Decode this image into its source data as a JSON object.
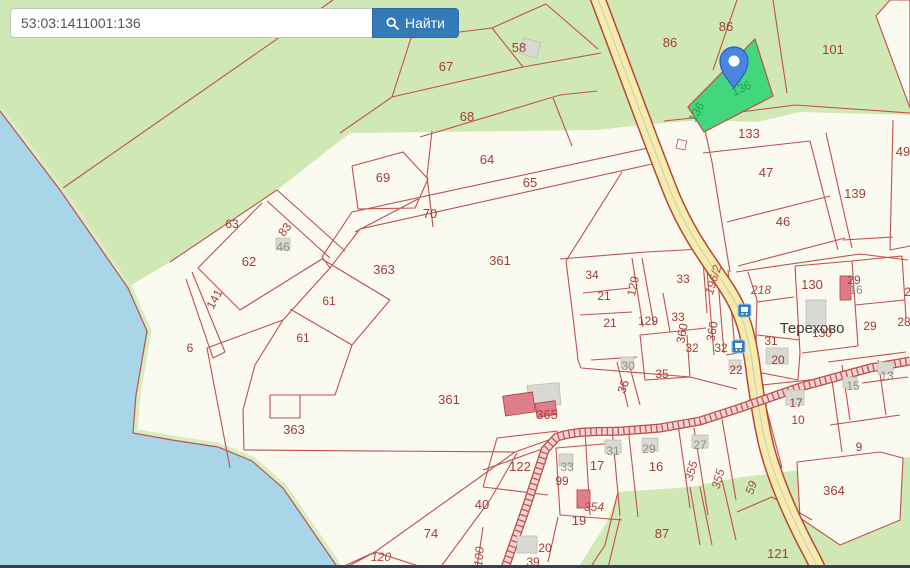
{
  "search": {
    "value": "53:03:1411001:136",
    "placeholder": "",
    "button_label": "Найти"
  },
  "map": {
    "place_label": "Терехово",
    "highlighted_parcel": "136",
    "colors": {
      "accent_button": "#337ab7",
      "parcel_line": "#c0504d",
      "highlight_parcel_fill": "#42d77d",
      "water": "#a8d5e8",
      "forest": "#cfe8b4",
      "land": "#fbfaf1",
      "road_fill": "#f6edaa",
      "building": "#d9d9d3",
      "building_red": "#e07b84"
    },
    "labels": [
      {
        "t": "58",
        "x": 519,
        "y": 52,
        "c": "r13"
      },
      {
        "t": "67",
        "x": 446,
        "y": 71,
        "c": "r13"
      },
      {
        "t": "68",
        "x": 467,
        "y": 121,
        "c": "r13"
      },
      {
        "t": "86",
        "x": 670,
        "y": 47,
        "c": "r13"
      },
      {
        "t": "86",
        "x": 726,
        "y": 31,
        "c": "r13"
      },
      {
        "t": "101",
        "x": 833,
        "y": 54,
        "c": "r13"
      },
      {
        "t": "49",
        "x": 903,
        "y": 156,
        "c": "r13"
      },
      {
        "t": "133",
        "x": 749,
        "y": 138,
        "c": "r13"
      },
      {
        "t": "47",
        "x": 766,
        "y": 177,
        "c": "r13"
      },
      {
        "t": "46",
        "x": 783,
        "y": 226,
        "c": "r13"
      },
      {
        "t": "139",
        "x": 855,
        "y": 198,
        "c": "r13"
      },
      {
        "t": "64",
        "x": 487,
        "y": 164,
        "c": "r13"
      },
      {
        "t": "65",
        "x": 530,
        "y": 187,
        "c": "r13"
      },
      {
        "t": "69",
        "x": 383,
        "y": 182,
        "c": "r13"
      },
      {
        "t": "70",
        "x": 430,
        "y": 218,
        "c": "r13"
      },
      {
        "t": "63",
        "x": 232,
        "y": 228
      },
      {
        "t": "83",
        "x": 288,
        "y": 232,
        "r": -52
      },
      {
        "t": "46",
        "x": 283,
        "y": 251,
        "c": "gray"
      },
      {
        "t": "62",
        "x": 249,
        "y": 266,
        "c": "r13"
      },
      {
        "t": "141",
        "x": 218,
        "y": 301,
        "r": -62
      },
      {
        "t": "61",
        "x": 329,
        "y": 305
      },
      {
        "t": "61",
        "x": 303,
        "y": 342
      },
      {
        "t": "6",
        "x": 190,
        "y": 352
      },
      {
        "t": "363",
        "x": 384,
        "y": 274,
        "c": "r13"
      },
      {
        "t": "361",
        "x": 500,
        "y": 265,
        "c": "r13"
      },
      {
        "t": "361",
        "x": 449,
        "y": 404,
        "c": "r13"
      },
      {
        "t": "363",
        "x": 294,
        "y": 434,
        "c": "r13"
      },
      {
        "t": "34",
        "x": 592,
        "y": 279
      },
      {
        "t": "21",
        "x": 604,
        "y": 300
      },
      {
        "t": "21",
        "x": 610,
        "y": 327
      },
      {
        "t": "129",
        "x": 637,
        "y": 287,
        "r": -78
      },
      {
        "t": "129",
        "x": 648,
        "y": 325
      },
      {
        "t": "33",
        "x": 683,
        "y": 283
      },
      {
        "t": "33",
        "x": 678,
        "y": 321
      },
      {
        "t": "360",
        "x": 686,
        "y": 334,
        "r": -80
      },
      {
        "t": "32",
        "x": 692,
        "y": 352
      },
      {
        "t": "360",
        "x": 716,
        "y": 332,
        "r": -80
      },
      {
        "t": "32",
        "x": 721,
        "y": 352
      },
      {
        "t": "35",
        "x": 662,
        "y": 378
      },
      {
        "t": "36",
        "x": 627,
        "y": 388,
        "r": -70
      },
      {
        "t": "30",
        "x": 628,
        "y": 370,
        "c": "gray"
      },
      {
        "t": "196/2",
        "x": 717,
        "y": 281,
        "r": -73,
        "c": "ri"
      },
      {
        "t": "218",
        "x": 761,
        "y": 294,
        "c": "ital"
      },
      {
        "t": "130",
        "x": 812,
        "y": 289,
        "c": "r13"
      },
      {
        "t": "29",
        "x": 854,
        "y": 284
      },
      {
        "t": "16",
        "x": 856,
        "y": 294,
        "c": "gray"
      },
      {
        "t": "29",
        "x": 870,
        "y": 330
      },
      {
        "t": "28",
        "x": 904,
        "y": 326
      },
      {
        "t": "29",
        "x": 911,
        "y": 296
      },
      {
        "t": "Терехово",
        "x": 812,
        "y": 333,
        "c": "place"
      },
      {
        "t": "130",
        "x": 822,
        "y": 337
      },
      {
        "t": "31",
        "x": 771,
        "y": 345
      },
      {
        "t": "20",
        "x": 778,
        "y": 364
      },
      {
        "t": "22",
        "x": 736,
        "y": 374
      },
      {
        "t": "13",
        "x": 887,
        "y": 380,
        "c": "gray"
      },
      {
        "t": "15",
        "x": 853,
        "y": 390,
        "c": "gray"
      },
      {
        "t": "17",
        "x": 796,
        "y": 407
      },
      {
        "t": "10",
        "x": 798,
        "y": 424
      },
      {
        "t": "9",
        "x": 859,
        "y": 451
      },
      {
        "t": "59",
        "x": 755,
        "y": 489,
        "r": -70,
        "c": "ri"
      },
      {
        "t": "364",
        "x": 834,
        "y": 495,
        "c": "r13"
      },
      {
        "t": "121",
        "x": 778,
        "y": 558,
        "c": "r13"
      },
      {
        "t": "122",
        "x": 520,
        "y": 471,
        "c": "r13"
      },
      {
        "t": "99",
        "x": 562,
        "y": 485
      },
      {
        "t": "33",
        "x": 567,
        "y": 471,
        "c": "gray"
      },
      {
        "t": "17",
        "x": 597,
        "y": 470,
        "c": "r13"
      },
      {
        "t": "31",
        "x": 613,
        "y": 455,
        "c": "gray"
      },
      {
        "t": "29",
        "x": 649,
        "y": 453,
        "c": "gray"
      },
      {
        "t": "16",
        "x": 656,
        "y": 471,
        "c": "r13"
      },
      {
        "t": "27",
        "x": 700,
        "y": 449,
        "c": "gray"
      },
      {
        "t": "355",
        "x": 695,
        "y": 472,
        "r": -75,
        "c": "ri"
      },
      {
        "t": "355",
        "x": 722,
        "y": 480,
        "r": -75,
        "c": "ri"
      },
      {
        "t": "365",
        "x": 547,
        "y": 419,
        "c": "b365"
      },
      {
        "t": "354",
        "x": 594,
        "y": 511,
        "c": "ital"
      },
      {
        "t": "19",
        "x": 579,
        "y": 525,
        "c": "r13"
      },
      {
        "t": "20",
        "x": 545,
        "y": 552
      },
      {
        "t": "39",
        "x": 533,
        "y": 566
      },
      {
        "t": "87",
        "x": 662,
        "y": 538,
        "c": "r13"
      },
      {
        "t": "40",
        "x": 482,
        "y": 509,
        "c": "r13"
      },
      {
        "t": "74",
        "x": 431,
        "y": 538,
        "c": "r13"
      },
      {
        "t": "120",
        "x": 381,
        "y": 561,
        "c": "ital"
      },
      {
        "t": "100",
        "x": 483,
        "y": 557,
        "r": -85,
        "c": "ri"
      },
      {
        "t": "136",
        "x": 700,
        "y": 114,
        "r": -62,
        "c": "grn"
      },
      {
        "t": "136",
        "x": 743,
        "y": 92,
        "r": -25,
        "c": "grn"
      }
    ]
  }
}
